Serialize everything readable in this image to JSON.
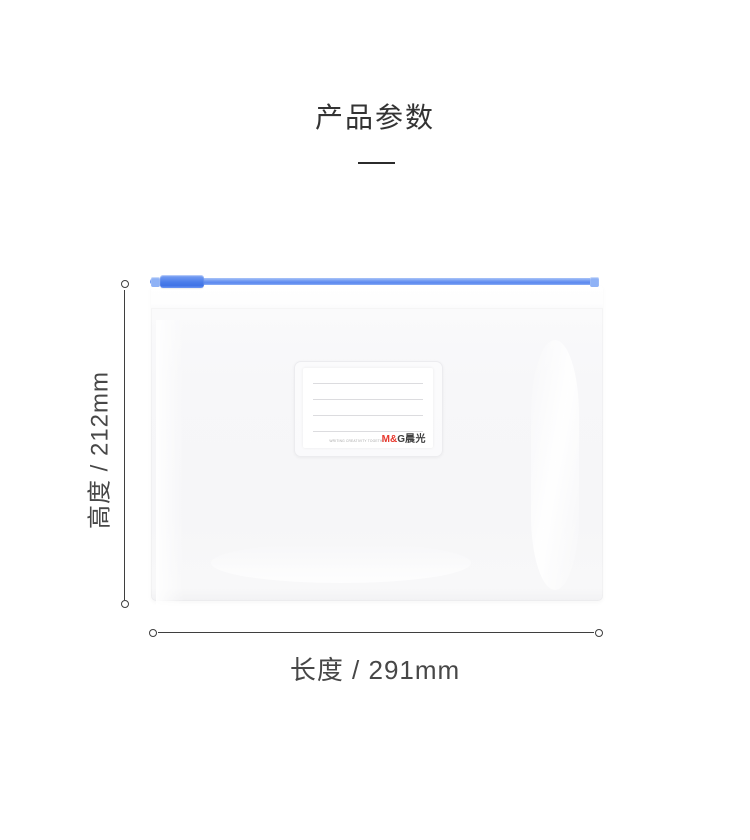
{
  "header": {
    "title": "产品参数"
  },
  "product_label": {
    "slogan": "WRITING CREATIVITY TOGETHER",
    "brand_latin_red": "M&",
    "brand_latin_dark": "G",
    "brand_cn": "晨光",
    "line_count": 4
  },
  "dimensions": {
    "height_label": "高度 / 212mm",
    "length_label": "长度 / 291mm"
  },
  "colors": {
    "background": "#ffffff",
    "title_text": "#333333",
    "dimension_text": "#474747",
    "dimension_line": "#3f3f3f",
    "zipper_rail_blue": "#6d97f2",
    "zipper_slider_blue": "#4a7dea",
    "brand_red": "#e8392e",
    "brand_dark": "#3f3f3f",
    "card_line": "#dcdcdf"
  }
}
